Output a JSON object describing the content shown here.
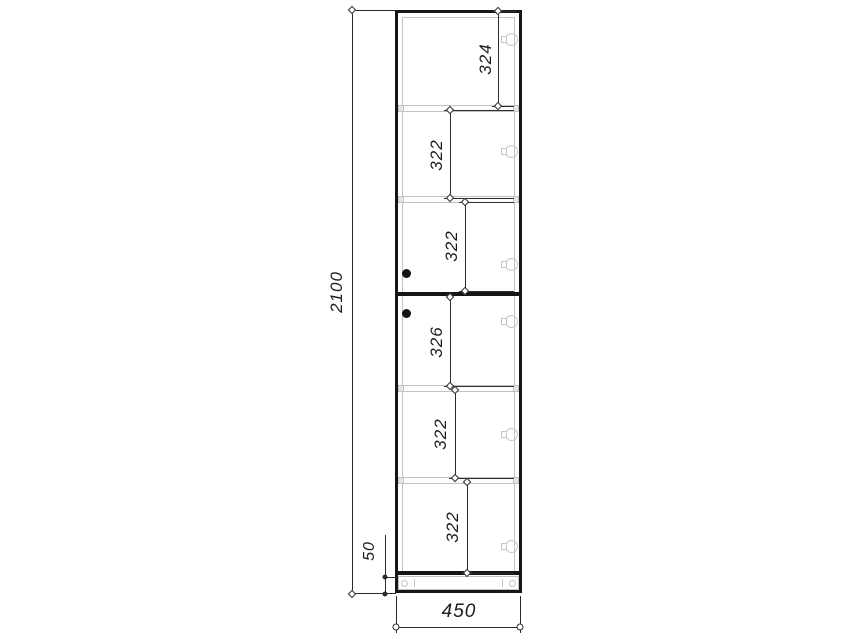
{
  "colors": {
    "background": "#ffffff",
    "outline": "#161616",
    "dimension": "#2b2b2b",
    "soft": "#c2c2c2",
    "hardware": "#c6c6c6"
  },
  "dimensions": {
    "overall_height": "2100",
    "plinth_height": "50",
    "overall_width": "450",
    "compartments": [
      "324",
      "322",
      "322",
      "326",
      "322",
      "322"
    ]
  }
}
